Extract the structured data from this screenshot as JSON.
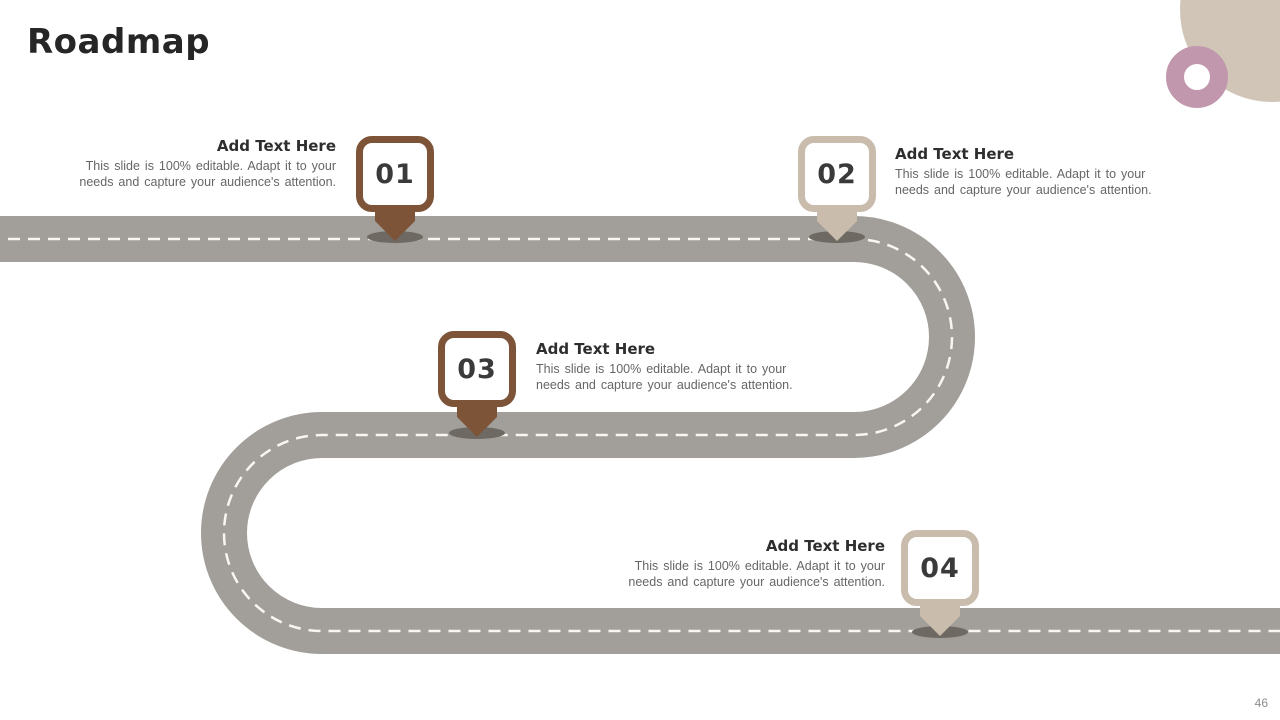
{
  "slide": {
    "title": "Roadmap",
    "page_number": "46"
  },
  "colors": {
    "road_gray": "#a29f9a",
    "lane_dash": "#f7f6f3",
    "marker_brown": "#7d5438",
    "marker_beige": "#cabcac",
    "pointer_shadow": "#6e6a63",
    "accent_circle_beige": "#d0c5b6",
    "accent_ring_mauve": "#c197ae"
  },
  "markers": [
    {
      "number": "01",
      "heading": "Add Text Here",
      "body_lines": [
        "This slide is 100% editable. Adapt it to your",
        "needs and capture your audience's attention."
      ]
    },
    {
      "number": "02",
      "heading": "Add Text Here",
      "body_lines": [
        "This slide is 100% editable. Adapt it to your",
        "needs and capture your audience's attention."
      ]
    },
    {
      "number": "03",
      "heading": "Add Text Here",
      "body_lines": [
        "This slide is 100% editable. Adapt it to your",
        "needs and capture your audience's attention."
      ]
    },
    {
      "number": "04",
      "heading": "Add Text Here",
      "body_lines": [
        "This slide is 100% editable. Adapt it to your",
        "needs and capture your audience's attention."
      ]
    }
  ]
}
